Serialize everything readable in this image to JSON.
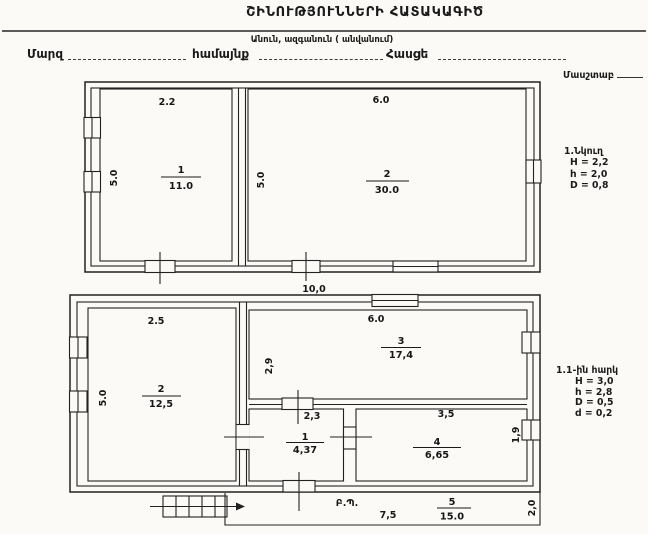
{
  "header": {
    "title": "ՇԻՆՈՒԹՅՈՒՆՆԵՐԻ ՀԱՏԱԿԱԳԻԾ",
    "subtitle": "Անուն, ազգանուն ( անվանում)",
    "region_label": "Մարզ",
    "community_label": "համայնք",
    "address_label": "Հասցե",
    "scale_label": "Մասշտաբ"
  },
  "basement": {
    "note_title": "1.Նկուղ",
    "note_H": "H = 2,2",
    "note_h": "h = 2,0",
    "note_D": "D = 0,8",
    "room1": {
      "num": "1",
      "area": "11.0",
      "width_dim": "2.2",
      "depth_dim": "5.0"
    },
    "room2": {
      "num": "2",
      "area": "30.0",
      "width_dim": "6.0",
      "depth_dim": "5.0"
    },
    "overall_width_dim": "10,0"
  },
  "first_floor": {
    "note_title": "1.1-ին հարկ",
    "note_H": "H = 3,0",
    "note_h": "h = 2,8",
    "note_D": "D = 0,5",
    "note_d": "d = 0,2",
    "door_width_dim": "2,3",
    "room1": {
      "num": "1",
      "area": "4,37"
    },
    "room2": {
      "num": "2",
      "area": "12,5",
      "width_dim": "2.5",
      "depth_dim": "5.0"
    },
    "room3": {
      "num": "3",
      "area": "17,4",
      "width_dim": "6.0",
      "depth_dim": "2,9"
    },
    "room4": {
      "num": "4",
      "area": "6,65",
      "width_dim": "3,5",
      "depth_dim": "1,9"
    },
    "room5": {
      "num": "5",
      "area": "15.0",
      "label": "Բ.Պ.",
      "length_dim": "7,5",
      "depth_dim": "2,0"
    }
  }
}
